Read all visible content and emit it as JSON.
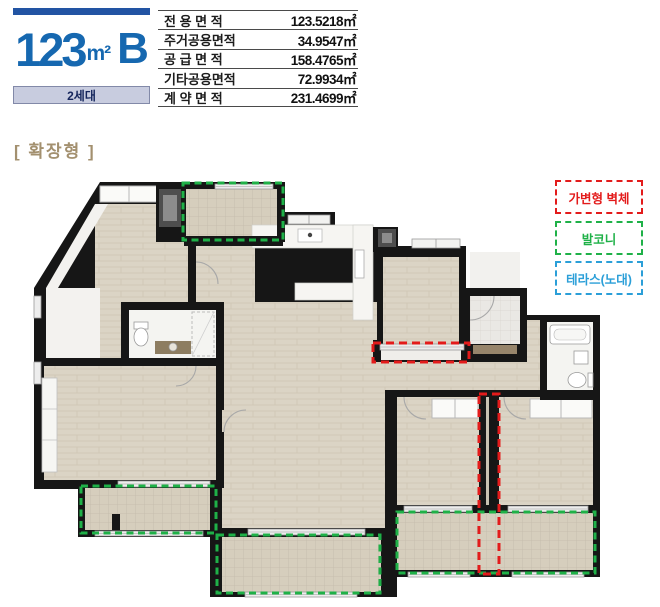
{
  "header": {
    "size_value": "123",
    "size_unit": "m²",
    "type_suffix": "B",
    "households_label": "2세대"
  },
  "area_table": {
    "rows": [
      {
        "label": "전 용 면 적",
        "value": "123.5218㎡"
      },
      {
        "label": "주거공용면적",
        "value": "34.9547㎡"
      },
      {
        "label": "공 급 면 적",
        "value": "158.4765㎡"
      },
      {
        "label": "기타공용면적",
        "value": "72.9934㎡"
      },
      {
        "label": "계 약 면 적",
        "value": "231.4699㎡"
      }
    ]
  },
  "plan": {
    "variant_label": "[ 확장형 ]"
  },
  "legend": {
    "items": [
      {
        "label": "가변형 벽체",
        "color": "#e31b1b"
      },
      {
        "label": "발코니",
        "color": "#1fb148"
      },
      {
        "label": "테라스(노대)",
        "color": "#2b9fd8"
      }
    ]
  },
  "colors": {
    "header_blue": "#1668b0",
    "header_bar_blue": "#2254a3",
    "households_bg": "#c8ccdf",
    "variant_label_color": "#a3906f",
    "wall_black": "#161616",
    "floor_beige": "#dbd4c5"
  }
}
